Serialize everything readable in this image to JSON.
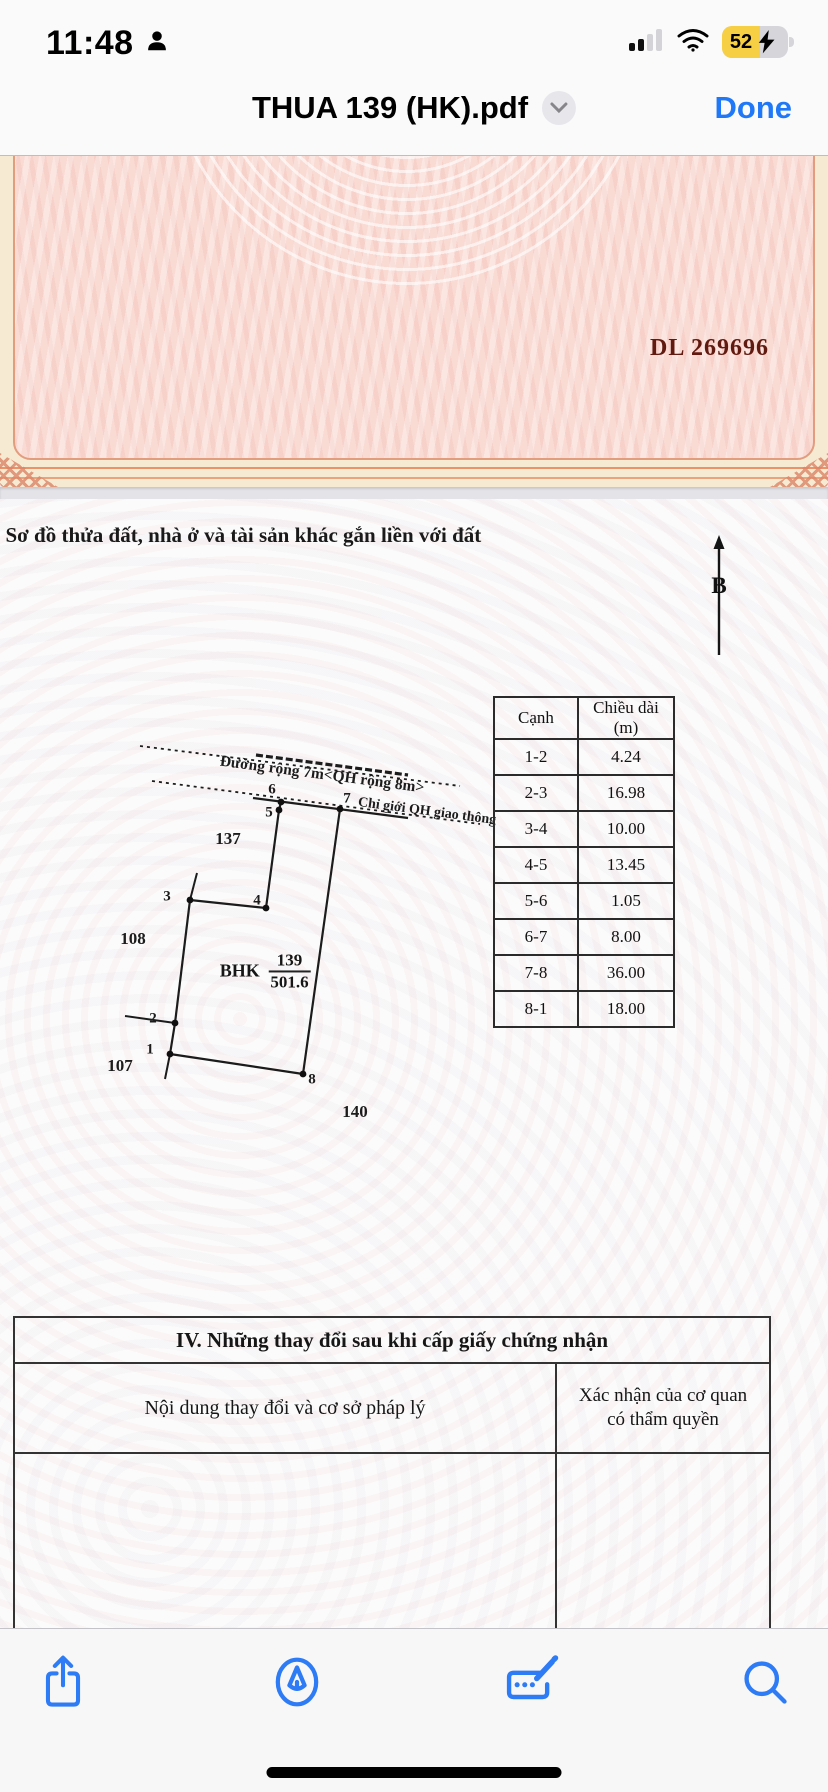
{
  "status_bar": {
    "time": "11:48",
    "battery_percent": "52"
  },
  "title_bar": {
    "title": "THUA 139 (HK).pdf",
    "done_label": "Done"
  },
  "certificate": {
    "serial": "DL 269696"
  },
  "page": {
    "heading": ". Sơ đồ thửa đất, nhà ở và tài sản khác gắn liền với đất",
    "north_label": "B"
  },
  "diagram": {
    "road_label": "Đường rộng 7m<QH rộng 8m>",
    "boundary_label": "Chỉ giới QH giao thông",
    "plot_code": "BHK",
    "plot_number": "139",
    "plot_area": "501.6",
    "vertex_labels": [
      "1",
      "2",
      "3",
      "4",
      "5",
      "6",
      "7",
      "8"
    ],
    "adjacent_parcels": [
      "137",
      "108",
      "107",
      "140"
    ]
  },
  "edge_table": {
    "headers": [
      "Cạnh",
      "Chiều dài (m)"
    ],
    "rows": [
      {
        "edge": "1-2",
        "length": "4.24"
      },
      {
        "edge": "2-3",
        "length": "16.98"
      },
      {
        "edge": "3-4",
        "length": "10.00"
      },
      {
        "edge": "4-5",
        "length": "13.45"
      },
      {
        "edge": "5-6",
        "length": "1.05"
      },
      {
        "edge": "6-7",
        "length": "8.00"
      },
      {
        "edge": "7-8",
        "length": "36.00"
      },
      {
        "edge": "8-1",
        "length": "18.00"
      }
    ]
  },
  "section4": {
    "title": "IV. Những thay đổi sau khi cấp giấy chứng nhận",
    "col1": "Nội dung thay đổi và cơ sở pháp lý",
    "col2": "Xác nhận của cơ quan có thẩm quyền"
  },
  "toolbar": {
    "icons": [
      "share",
      "markup",
      "autofill-signature",
      "search"
    ]
  }
}
